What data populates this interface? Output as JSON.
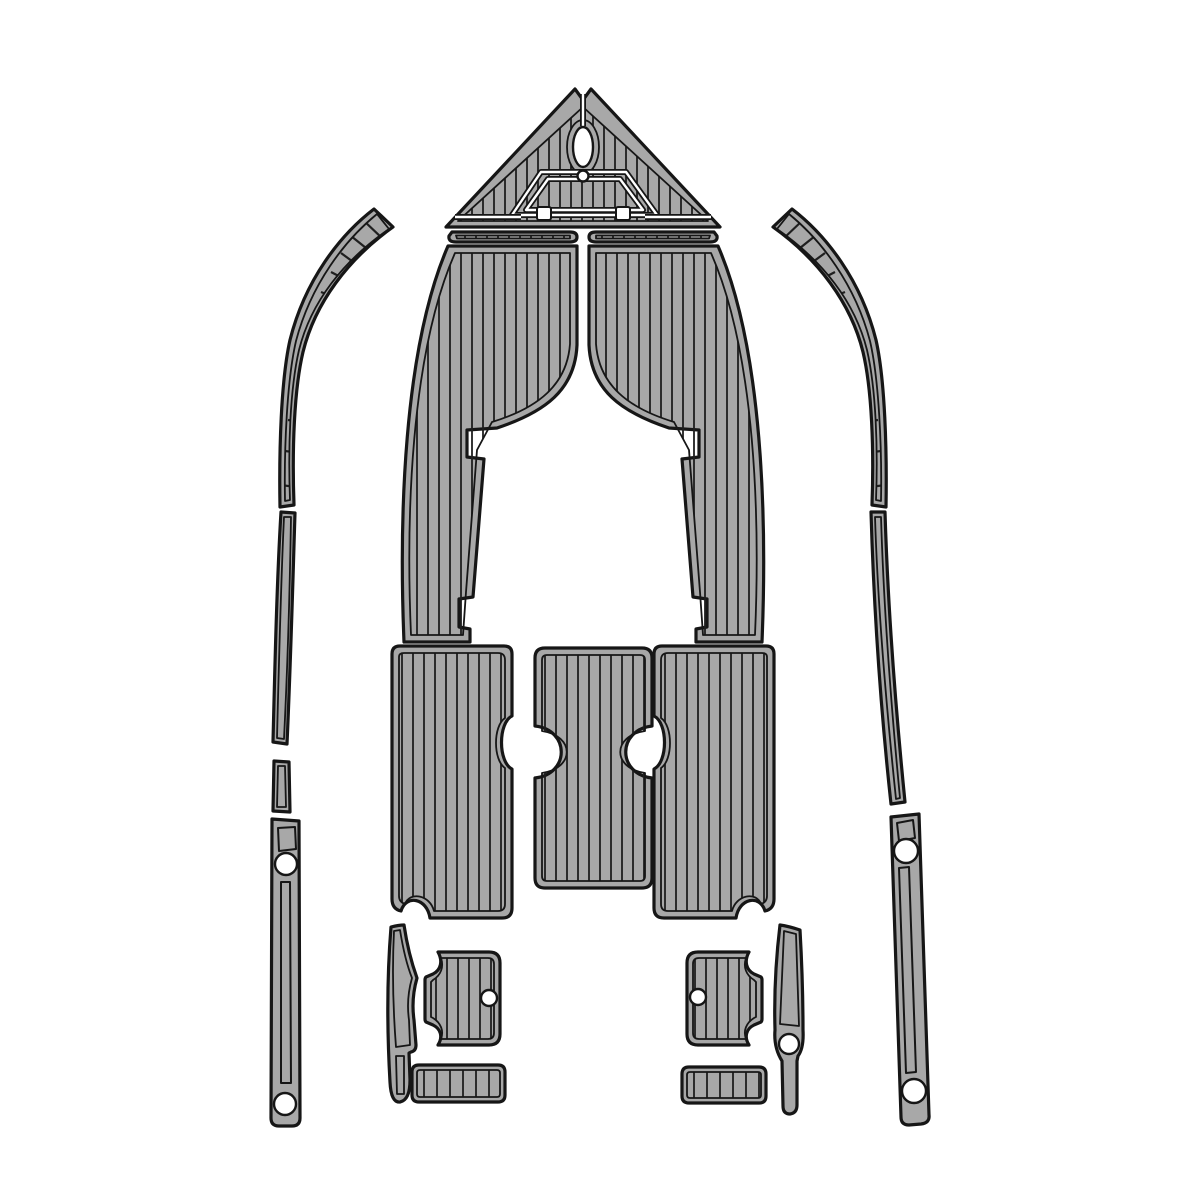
{
  "canvas": {
    "width": 1200,
    "height": 1200,
    "background": "#ffffff"
  },
  "mirror_axis_x": 583,
  "colors": {
    "pad": "#a8a8a8",
    "line": "#161616",
    "stripe": "#1f1f1f",
    "cutout": "#ffffff"
  },
  "pieces": [
    {
      "name": "bow-pad",
      "outer": "M 575,89 L 583,100 L 591,89 L 720,227 L 446,227 Z",
      "inner": "M 583,107 L 458,221 L 708,221 Z M 567,147 a 16,27 0 1 0 32,0 a 16,27 0 1 0 -32,0 Z",
      "stripes": {
        "kind": "v",
        "x1": 450,
        "x2": 716,
        "step": 11,
        "y1": 85,
        "y2": 226
      },
      "details": [
        {
          "type": "groove",
          "d": "M 583,94 L 583,126"
        },
        {
          "type": "groove",
          "d": "M 512,215 L 541,172 L 626,172 L 657,215 Z"
        },
        {
          "type": "groove",
          "d": "M 526,210 L 548,179 L 620,179 L 643,210 Z"
        },
        {
          "type": "groove",
          "d": "M 455,217 L 521,217"
        },
        {
          "type": "groove",
          "d": "M 645,217 L 711,217"
        }
      ],
      "holes": [
        {
          "type": "ellipse",
          "cx": 583,
          "cy": 147,
          "rx": 10,
          "ry": 20
        },
        {
          "type": "circle",
          "cx": 583,
          "cy": 176,
          "r": 5.5
        },
        {
          "type": "rect",
          "x": 537,
          "y": 207,
          "w": 14,
          "h": 13,
          "rx": 2
        },
        {
          "type": "rect",
          "x": 616,
          "y": 207,
          "w": 14,
          "h": 13,
          "rx": 2
        }
      ]
    },
    {
      "name": "bow-side-strip-port",
      "outer": "M 452,232 L 570,232 Q 577,232 577,237 Q 577,242 570,242 L 456,242 Q 448,242 449,236 Z",
      "inner": "M 456,235.5 L 570,235.5 L 570,238.5 L 457,238.5 Z",
      "stripes": {
        "kind": "v",
        "x1": 454,
        "x2": 572,
        "step": 11,
        "y1": 230,
        "y2": 244
      }
    },
    {
      "name": "bow-side-strip-starboard",
      "sameAs": "bow-side-strip-port",
      "mirror": true
    },
    {
      "name": "port-cockpit-panel",
      "outer": "M 448,246 L 577,246 L 577,345 C 575,390 545,412 497,428 L 467,430 L 467,457 L 484,459 L 473,597 L 459,599 L 459,627 L 470,629 L 470,642 L 404,642 C 399,520 403,350 448,246 Z",
      "inner": "M 455,253 L 570,253 L 570,344 C 567,385 538,408 492,422 L 477,450 L 466,592 L 463,635 L 411,635 C 406,520 410,355 455,253 Z",
      "stripes": {
        "kind": "v",
        "x1": 406,
        "x2": 576,
        "step": 11,
        "y1": 246,
        "y2": 642
      }
    },
    {
      "name": "starboard-cockpit-panel",
      "sameAs": "port-cockpit-panel",
      "mirror": true
    },
    {
      "name": "port-aft-floor-panel",
      "outer": "M 400,646 L 504,646 Q 512,646 512,654 L 512,716 C 498,723 498,762 512,769 L 512,908 Q 512,918 502,918 L 430,918 C 427,898 406,894 401,911 Q 392,909 392,899 L 392,654 Q 392,646 400,646 Z",
      "inner": "M 404,653 L 498,653 Q 505,653 505,660 L 505,718 C 493,726 493,760 505,768 L 505,904 Q 505,911 498,911 L 434,911 C 430,895 410,891 405,904 Q 399,902 399,896 L 399,657 Q 399,653 404,653 Z",
      "stripes": {
        "kind": "v",
        "x1": 402,
        "x2": 509,
        "step": 11,
        "y1": 646,
        "y2": 918
      }
    },
    {
      "name": "starboard-aft-floor-panel",
      "sameAs": "port-aft-floor-panel",
      "mirror": true
    },
    {
      "name": "center-console-panel",
      "outer": "M 545,648 L 642,648 Q 652,648 652,658 L 652,726 C 617,730 617,774 652,778 L 652,878 Q 652,888 642,888 L 545,888 Q 535,888 535,878 L 535,778 C 570,774 570,730 535,726 L 535,658 Q 535,648 545,648 Z",
      "inner": "M 547,655 L 640,655 Q 645,655 645,660 L 645,731 C 612,736 612,768 645,773 L 645,876 Q 645,881 640,881 L 547,881 Q 542,881 542,876 L 542,773 C 575,768 575,736 542,731 L 542,660 Q 542,655 547,655 Z",
      "stripes": {
        "kind": "v",
        "x1": 545,
        "x2": 649,
        "step": 11,
        "y1": 648,
        "y2": 888
      }
    },
    {
      "name": "port-gunwale-bow-strip",
      "outer": "M 374,209 C 340,235 305,280 290,340 C 281,380 279,450 280,507 L 294,505 C 292,450 294,390 303,352 C 315,303 348,259 393,227 Z",
      "inner": "M 377,214 C 345,240 311,284 296,341 C 287,380 284,448 285,501 L 290,500 C 288,448 290,389 299,350 C 311,302 343,261 389,229 Z",
      "stripes": {
        "kind": "lines",
        "segs": [
          [
            383,
            239,
            363,
            220
          ],
          [
            371,
            252,
            351,
            236
          ],
          [
            360,
            267,
            341,
            253
          ],
          [
            350,
            282,
            331,
            272
          ],
          [
            341,
            300,
            321,
            292
          ],
          [
            332,
            320,
            313,
            313
          ],
          [
            324,
            343,
            305,
            337
          ],
          [
            317,
            367,
            298,
            363
          ],
          [
            311,
            394,
            293,
            390
          ],
          [
            305,
            422,
            288,
            420
          ],
          [
            300,
            453,
            285,
            451
          ],
          [
            296,
            487,
            281,
            485
          ]
        ]
      }
    },
    {
      "name": "starboard-gunwale-bow-strip",
      "sameAs": "port-gunwale-bow-strip",
      "mirror": true
    },
    {
      "name": "port-gunwale-mid-strip",
      "outer": "M 281,512 L 295,513 C 293,575 291,655 287,744 L 273,742 C 275,660 277,578 281,512 Z",
      "inner": "M 284,517 L 291,517 C 290,580 288,658 284,739 L 277,738 C 279,658 281,580 284,517 Z"
    },
    {
      "name": "starboard-gunwale-mid-strip",
      "outer": "M 871,512 L 885,512 C 888,612 896,712 905,802 L 891,804 C 881,712 874,612 871,512 Z",
      "inner": "M 875,517 L 881,517 C 884,617 892,715 900,798 L 896,799 C 887,713 878,613 875,517 Z"
    },
    {
      "name": "port-gunwale-short-strip",
      "outer": "M 274,761 L 289,762 L 290,812 L 273,811 Z",
      "inner": "M 278,766 L 285,766 L 286,807 L 277,807 Z"
    },
    {
      "name": "port-transom-trim-strip",
      "outer": "M 272,819 L 299,821 L 300,1118 Q 300,1126 292,1126 L 279,1126 Q 271,1126 271,1118 Z",
      "details": [
        {
          "type": "outline",
          "d": "M 278,828 L 295,827 L 296,849 L 279,851 Z"
        },
        {
          "type": "outline",
          "d": "M 281,882 L 290,882 L 291,1083 L 281,1083 Z"
        }
      ],
      "holes": [
        {
          "type": "circle",
          "cx": 286,
          "cy": 864,
          "r": 11
        },
        {
          "type": "circle",
          "cx": 285,
          "cy": 1104,
          "r": 11
        }
      ]
    },
    {
      "name": "starboard-transom-trim-strip",
      "outer": "M 891,817 L 919,814 C 923,915 926,1015 929,1115 Q 930,1123 921,1124 L 909,1125 Q 901,1125 901,1117 C 897,1017 894,917 891,817 Z",
      "details": [
        {
          "type": "outline",
          "d": "M 897,823 L 913,820 L 915,838 L 899,841 Z"
        },
        {
          "type": "outline",
          "d": "M 899,868 L 909,867 L 916,1072 L 906,1073 Z"
        }
      ],
      "holes": [
        {
          "type": "circle",
          "cx": 906,
          "cy": 851,
          "r": 12
        },
        {
          "type": "circle",
          "cx": 914,
          "cy": 1091,
          "r": 12
        }
      ]
    },
    {
      "name": "port-step-pad",
      "outer": "M 438,952 L 489,952 Q 500,952 500,963 L 500,1034 Q 500,1045 489,1045 L 438,1045 C 443,1037 441,1029 433,1025 L 426,1022 Q 425,1021 425,1019 L 425,980 Q 425,978 426,977 L 433,974 C 441,970 443,961 438,952 Z",
      "inner": "M 441,958 L 488,958 Q 494,958 494,964 L 494,1033 Q 494,1039 488,1039 L 441,1039 C 444,1031 441,1023 433,1018 L 431,1017 L 431,982 L 433,980 C 441,975 444,967 441,958 Z",
      "stripes": {
        "kind": "v",
        "x1": 436,
        "x2": 492,
        "step": 11,
        "y1": 952,
        "y2": 1045
      },
      "holes": [
        {
          "type": "circle",
          "cx": 489,
          "cy": 998,
          "r": 8
        }
      ]
    },
    {
      "name": "starboard-step-pad",
      "outer": "M 749,952 L 698,952 Q 687,952 687,963 L 687,1034 Q 687,1045 698,1045 L 749,1045 C 744,1037 746,1029 754,1025 L 761,1022 Q 762,1021 762,1019 L 762,980 Q 762,978 761,977 L 754,974 C 746,970 744,961 749,952 Z",
      "inner": "M 746,958 L 699,958 Q 693,958 693,964 L 693,1033 Q 693,1039 699,1039 L 746,1039 C 743,1031 746,1023 754,1018 L 756,1017 L 756,982 L 754,980 C 746,975 743,967 746,958 Z",
      "stripes": {
        "kind": "v",
        "x1": 695,
        "x2": 751,
        "step": 11,
        "y1": 952,
        "y2": 1045
      },
      "holes": [
        {
          "type": "circle",
          "cx": 698,
          "cy": 997,
          "r": 8
        }
      ]
    },
    {
      "name": "port-step-sliver",
      "outer": "M 391,927 C 395,926 400,925 404,925 C 408,952 413,967 417,978 C 413,992 412,1006 414,1020 L 416,1045 Q 416,1051 411,1052 L 409,1053 L 410,1080 Q 410,1100 400,1102 Q 391,1103 390,1082 C 387,1030 387,976 391,927 Z",
      "inner": "M 394,931 L 400,930 C 404,955 408,968 412,978 C 408,992 407,1006 409,1020 L 410,1045 L 396,1047 C 393,1008 392,970 394,931 Z M 396,1056 L 404,1056 L 404,1094 L 397,1094 Z"
    },
    {
      "name": "starboard-step-sliver",
      "outer": "M 780,925 C 787,926 794,928 800,930 C 802,965 803,1000 803,1030 Q 804,1048 798,1056 L 797,1061 L 797,1105 Q 797,1113 790,1114 Q 783,1114 783,1106 L 782,1061 C 777,1053 774,1042 775,1030 C 774,995 776,958 780,925 Z",
      "inner": "M 784,931 L 796,934 L 799,1026 L 780,1024 Z",
      "holes": [
        {
          "type": "circle",
          "cx": 789,
          "cy": 1044,
          "r": 10
        }
      ]
    },
    {
      "name": "port-helm-bar",
      "outer": "M 419,1065 L 498,1065 Q 505,1065 505,1072 L 505,1095 Q 505,1102 498,1102 L 419,1102 Q 412,1102 412,1095 L 412,1072 Q 412,1065 419,1065 Z",
      "inner": "M 420,1070 L 497,1070 Q 500,1070 500,1073 L 500,1094 Q 500,1097 497,1097 L 420,1097 Q 417,1097 417,1094 L 417,1073 Q 417,1070 420,1070 Z",
      "stripes": {
        "kind": "v",
        "x1": 424,
        "x2": 500,
        "step": 13,
        "y1": 1065,
        "y2": 1102
      }
    },
    {
      "name": "starboard-helm-bar",
      "outer": "M 689,1067 L 759,1067 Q 766,1067 766,1074 L 766,1096 Q 766,1103 759,1103 L 689,1103 Q 682,1103 682,1096 L 682,1074 Q 682,1067 689,1067 Z",
      "inner": "M 690,1072 L 758,1072 Q 761,1072 761,1075 L 761,1095 Q 761,1098 758,1098 L 690,1098 Q 687,1098 687,1095 L 687,1075 Q 687,1072 690,1072 Z",
      "stripes": {
        "kind": "v",
        "x1": 694,
        "x2": 762,
        "step": 13,
        "y1": 1067,
        "y2": 1103
      }
    }
  ]
}
